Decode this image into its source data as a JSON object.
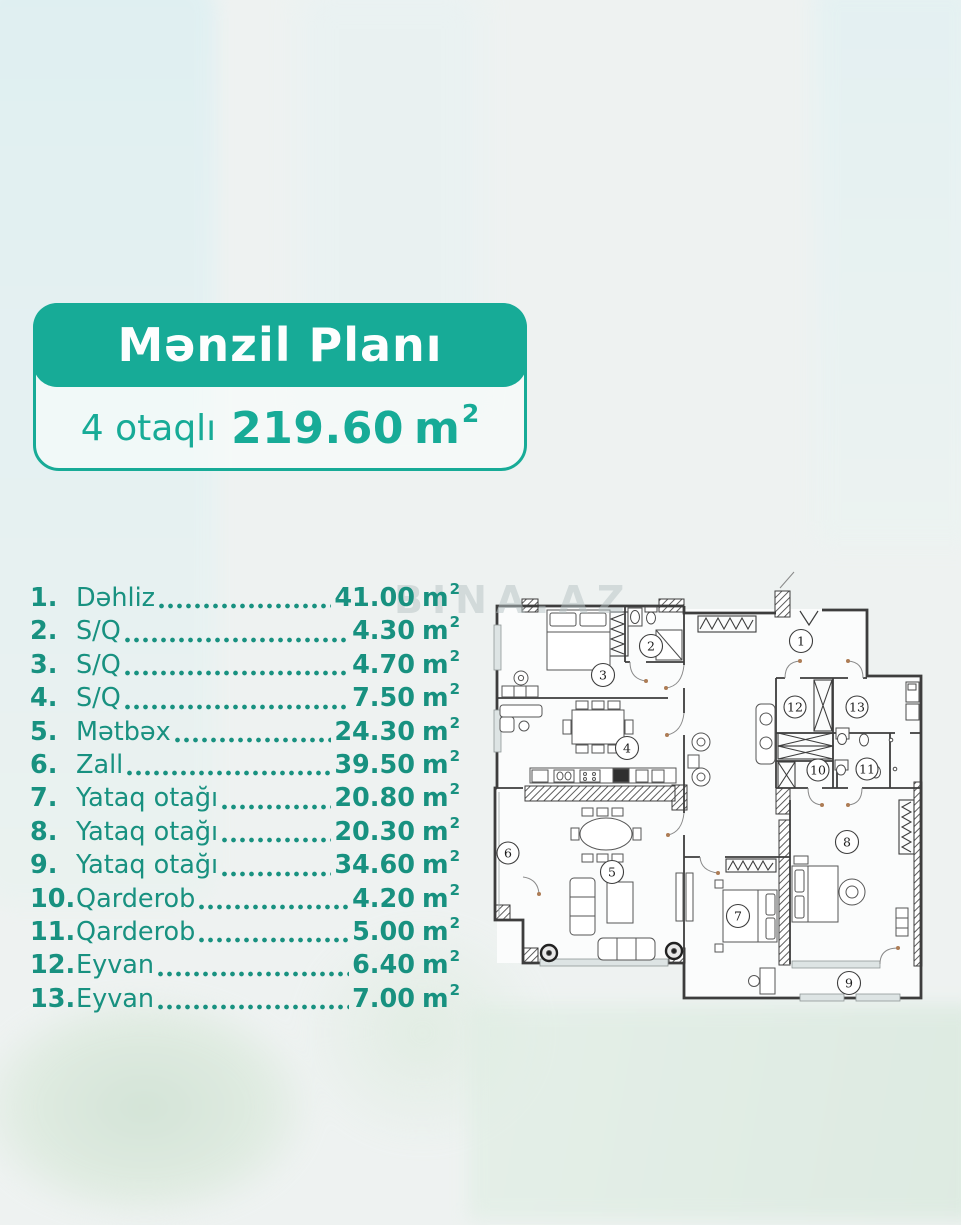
{
  "card": {
    "title": "Mənzil Planı",
    "subtitle_prefix": "4 otaqlı",
    "subtitle_value": "219.60",
    "subtitle_unit": "m",
    "subtitle_sup": "2",
    "accent_color": "#17ab97"
  },
  "list": {
    "unit": "m",
    "sup": "2",
    "text_color": "#189180",
    "items": [
      {
        "num": "1.",
        "name": "Dəhliz",
        "area": "41.00"
      },
      {
        "num": "2.",
        "name": "S/Q",
        "area": "4.30"
      },
      {
        "num": "3.",
        "name": "S/Q",
        "area": "4.70"
      },
      {
        "num": "4.",
        "name": "S/Q",
        "area": "7.50"
      },
      {
        "num": "5.",
        "name": "Mətbəx",
        "area": "24.30"
      },
      {
        "num": "6.",
        "name": "Zall",
        "area": "39.50"
      },
      {
        "num": "7.",
        "name": "Yataq otağı",
        "area": "20.80"
      },
      {
        "num": "8.",
        "name": "Yataq otağı",
        "area": "20.30"
      },
      {
        "num": "9.",
        "name": "Yataq otağı",
        "area": "34.60"
      },
      {
        "num": "10.",
        "name": "Qarderob",
        "area": "4.20"
      },
      {
        "num": "11.",
        "name": "Qarderob",
        "area": "5.00"
      },
      {
        "num": "12.",
        "name": "Eyvan",
        "area": "6.40"
      },
      {
        "num": "13.",
        "name": "Eyvan",
        "area": "7.00"
      }
    ]
  },
  "plan": {
    "watermark": "BINA.AZ",
    "room_labels": [
      "1",
      "2",
      "3",
      "4",
      "5",
      "6",
      "7",
      "8",
      "9",
      "10",
      "11",
      "12",
      "13"
    ]
  }
}
